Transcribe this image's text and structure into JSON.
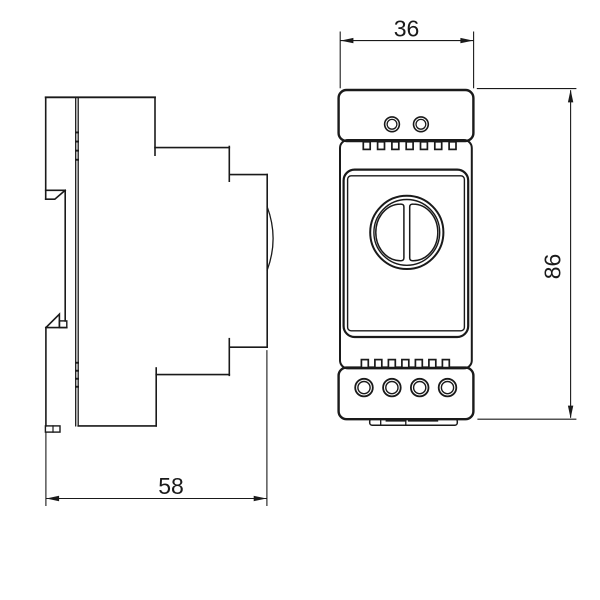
{
  "drawing": {
    "type": "technical-dimension-drawing",
    "subject": "DIN-rail mounted device, side view and front view",
    "colors": {
      "line": "#1a1a1a",
      "background": "#ffffff"
    },
    "dimensions": {
      "front_width": "36",
      "front_height": "86",
      "side_depth": "58"
    }
  }
}
